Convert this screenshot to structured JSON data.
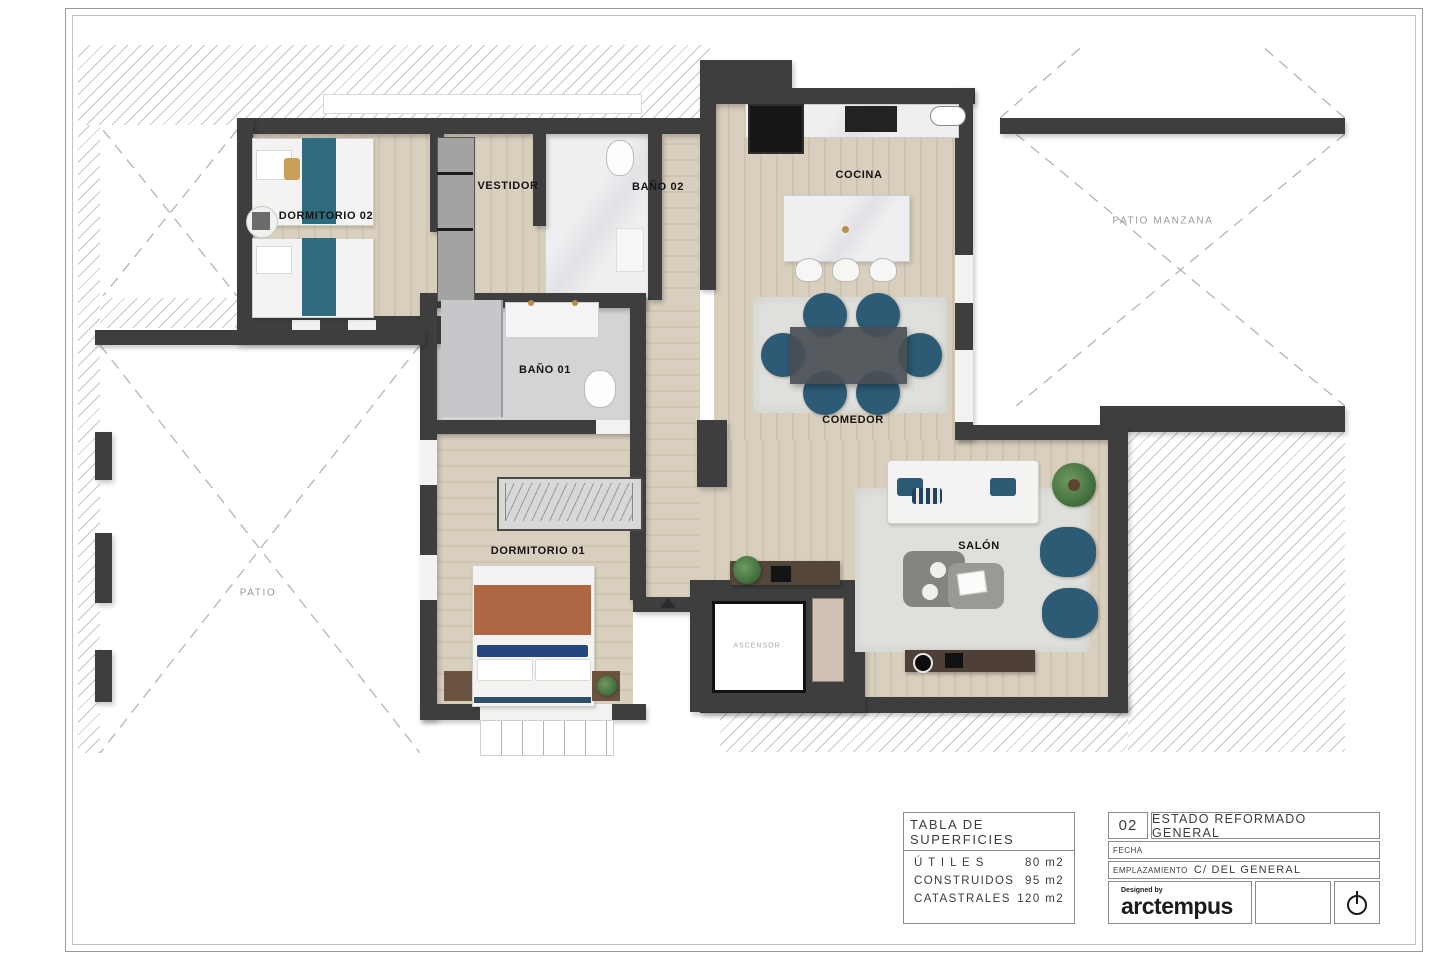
{
  "rooms": {
    "dormitorio02": "DORMITORIO 02",
    "vestidor": "VESTIDOR",
    "bano02": "BAÑO 02",
    "cocina": "COCINA",
    "patio_manzana": "PATIO MANZANA",
    "bano01": "BAÑO 01",
    "comedor": "COMEDOR",
    "dormitorio01": "DORMITORIO 01",
    "salon": "SALÓN",
    "patio": "PATIO",
    "ascensor": "ASCENSOR"
  },
  "surfaces": {
    "title": "TABLA DE SUPERFICIES",
    "rows": [
      {
        "label": "Ú T I L E S",
        "value": "80 m2"
      },
      {
        "label": "CONSTRUIDOS",
        "value": "95 m2"
      },
      {
        "label": "CATASTRALES",
        "value": "120 m2"
      }
    ]
  },
  "titleblock": {
    "sheet_number": "02",
    "sheet_title": "ESTADO REFORMADO GENERAL",
    "fecha_label": "FECHA",
    "emplazamiento_label": "EMPLAZAMIENTO",
    "emplazamiento_value": "C/ DEL GENERAL",
    "designed_by": "Designed by",
    "logo_text": "arctempus"
  },
  "colors": {
    "wall": "#3e3e3e",
    "floor": "#d9cfbe",
    "floor2": "#cfc4b0",
    "rug": "#dfdfdb",
    "hatch": "#c6c6c6",
    "teal": "#2e6b7f",
    "rust": "#ad6742",
    "blue": "#2d5a74"
  }
}
